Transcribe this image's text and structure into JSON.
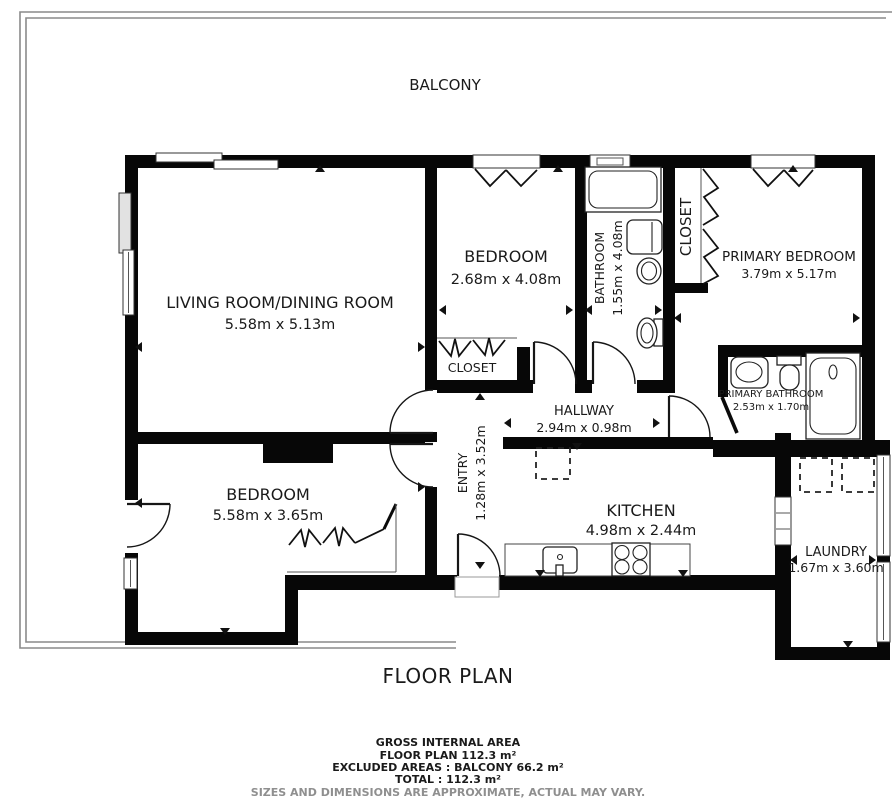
{
  "plan": {
    "balcony_label": "BALCONY",
    "title": "FLOOR PLAN"
  },
  "rooms": {
    "living": {
      "name": "LIVING ROOM/DINING ROOM",
      "dims": "5.58m x 5.13m"
    },
    "bedroom_top": {
      "name": "BEDROOM",
      "dims": "2.68m x 4.08m"
    },
    "bathroom": {
      "name": "BATHROOM",
      "dims": "1.55m x 4.08m"
    },
    "closet_hall": {
      "name": "CLOSET"
    },
    "closet_primary": {
      "name": "CLOSET"
    },
    "primary_bedroom": {
      "name": "PRIMARY BEDROOM",
      "dims": "3.79m x 5.17m"
    },
    "hallway": {
      "name": "HALLWAY",
      "dims": "2.94m x 0.98m"
    },
    "entry": {
      "name": "ENTRY",
      "dims": "1.28m x 3.52m"
    },
    "primary_bathroom": {
      "name": "PRIMARY BATHROOM",
      "dims": "2.53m x 1.70m"
    },
    "kitchen": {
      "name": "KITCHEN",
      "dims": "4.98m x 2.44m"
    },
    "bedroom_bottom": {
      "name": "BEDROOM",
      "dims": "5.58m x 3.65m"
    },
    "laundry": {
      "name": "LAUNDRY",
      "dims": "1.67m x 3.60m"
    }
  },
  "footer": {
    "area_heading": "GROSS INTERNAL AREA",
    "floor_plan_area": "FLOOR PLAN 112.3 m²",
    "excluded_areas": "EXCLUDED AREAS :  BALCONY 66.2 m²",
    "total": "TOTAL :  112.3 m²",
    "disclaimer": "SIZES AND DIMENSIONS ARE APPROXIMATE, ACTUAL MAY VARY."
  },
  "colors": {
    "wall": "#070707",
    "balcony_line": "#8a8a8a",
    "text": "#1a1a1a",
    "muted_text": "#8f8f8f",
    "background": "#ffffff"
  }
}
